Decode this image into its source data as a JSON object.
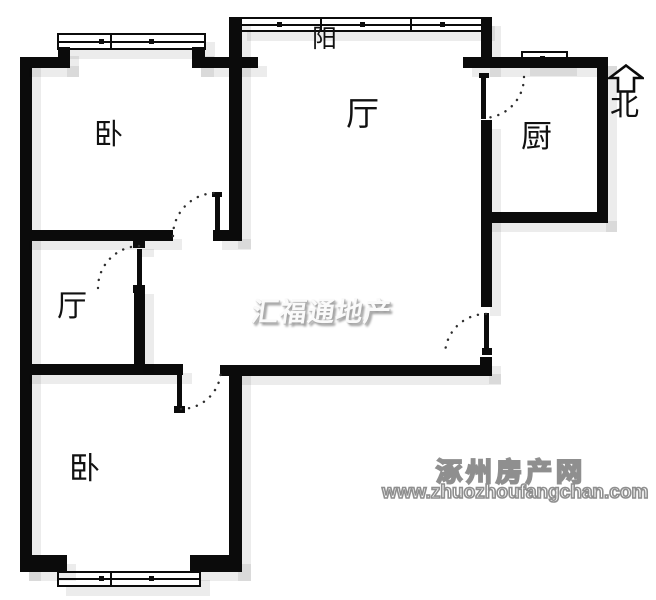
{
  "floorplan": {
    "rooms": [
      {
        "id": "balcony",
        "label": "阳"
      },
      {
        "id": "living-room",
        "label": "厅"
      },
      {
        "id": "kitchen",
        "label": "厨"
      },
      {
        "id": "bedroom-north",
        "label": "卧"
      },
      {
        "id": "hall",
        "label": "厅"
      },
      {
        "id": "bedroom-south",
        "label": "卧"
      }
    ],
    "compass": {
      "label": "北",
      "icon": "north-arrow-icon"
    },
    "watermarks": {
      "center": "汇福通地产",
      "site_name": "涿州房产网",
      "site_url": "www.zhuozhoufangchan.com"
    },
    "colors": {
      "wall": "#0b0b0b",
      "background": "#ffffff",
      "shadow": "rgba(0,0,0,0.075)",
      "watermark_gray": "#8f8f8f"
    }
  }
}
